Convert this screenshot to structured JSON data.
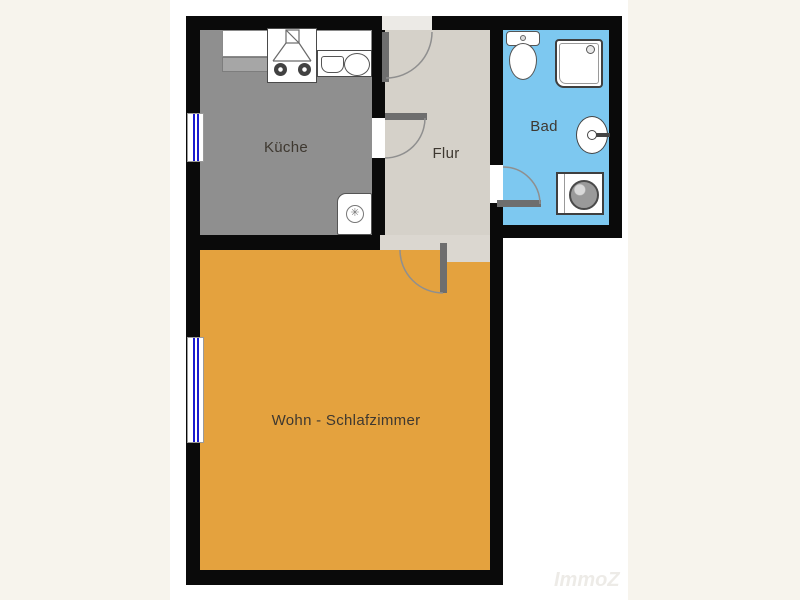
{
  "floorplan": {
    "rooms": [
      {
        "label": "Küche",
        "color": "#8F8F8F"
      },
      {
        "label": "Flur",
        "color": "#D5D1C9"
      },
      {
        "label": "Bad",
        "color": "#7DC8F0"
      },
      {
        "label": "Wohn - Schlafzimmer",
        "color": "#E4A23E"
      }
    ],
    "watermark": "ImmoZ",
    "colors": {
      "page_background": "#F7F4ED",
      "plan_background": "#FFFFFF",
      "wall": "#0A0A0A",
      "door_leaf": "#6E6E6E",
      "door_swing_arc": "#8F8F8F",
      "window_glass": "#1A1ACF",
      "threshold": "#DBD7D0",
      "label_text": "#3E3830"
    }
  }
}
